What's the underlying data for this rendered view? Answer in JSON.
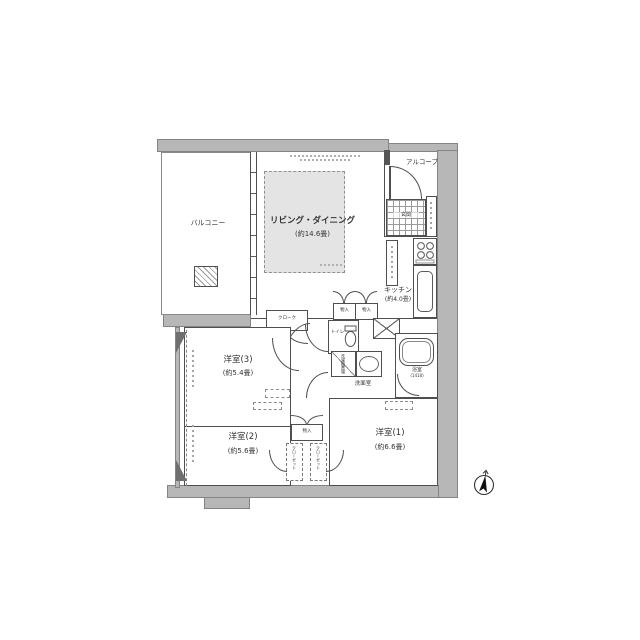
{
  "floorplan": {
    "balcony": {
      "label": "バルコニー"
    },
    "living_dining": {
      "label": "リビング・ダイニング",
      "size": "(約14.6畳)"
    },
    "alcove": {
      "label": "アルコーブ"
    },
    "entrance": {
      "label": "玄関"
    },
    "kitchen": {
      "label": "キッチン",
      "size": "(約4.0畳)"
    },
    "cloak": {
      "label": "クローク"
    },
    "toilet": {
      "label": "トイレ"
    },
    "washroom": {
      "label": "洗面室"
    },
    "laundry": {
      "label": "洗濯機置場"
    },
    "bathroom": {
      "label": "浴室",
      "size": "(1418)"
    },
    "storage1": {
      "label": "物入"
    },
    "storage2": {
      "label": "物入"
    },
    "storage3": {
      "label": "物入"
    },
    "closet1": {
      "label": "クローゼット"
    },
    "closet2": {
      "label": "クローゼット"
    },
    "bedroom3": {
      "label": "洋室(3)",
      "size": "(約5.4畳)"
    },
    "bedroom2": {
      "label": "洋室(2)",
      "size": "(約5.6畳)"
    },
    "bedroom1": {
      "label": "洋室(1)",
      "size": "(約6.6畳)"
    },
    "colors": {
      "wall": "#b7b7b7",
      "line": "#4f4f4f",
      "rug": "#e4e4e4"
    }
  }
}
